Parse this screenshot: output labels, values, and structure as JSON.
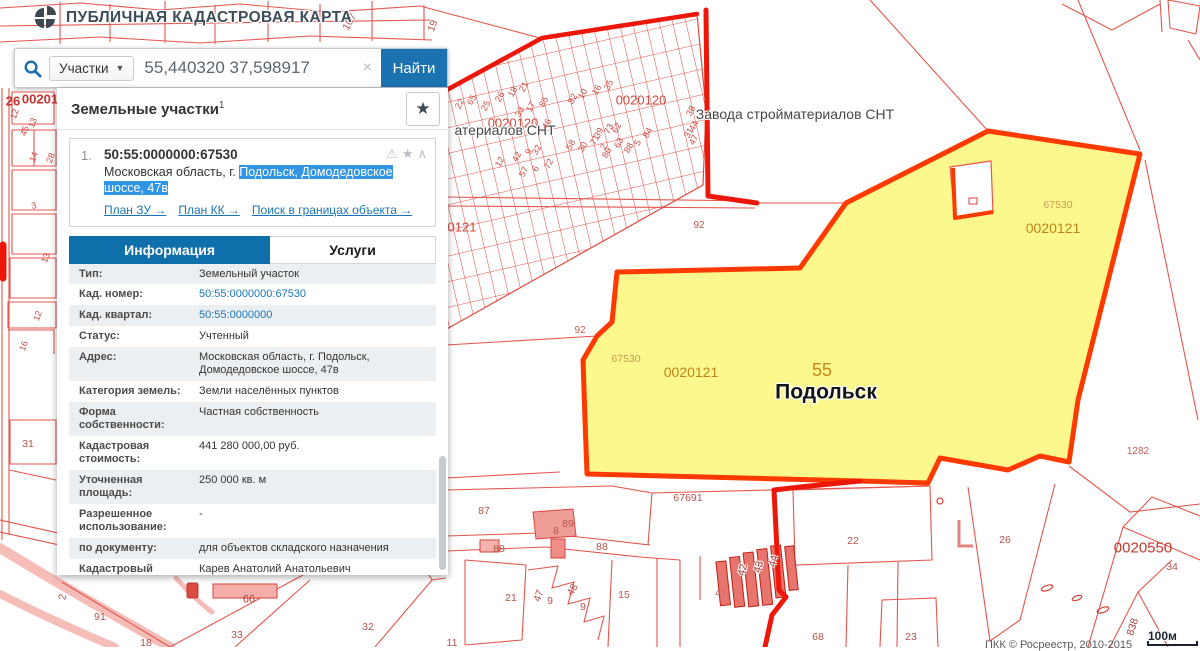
{
  "header": {
    "title": "ПУБЛИЧНАЯ КАДАСТРОВАЯ КАРТА"
  },
  "search": {
    "category": "Участки",
    "dropdown_arrow": "▼",
    "query": "55,440320 37,598917",
    "clear": "×",
    "submit": "Найти"
  },
  "panel": {
    "title": "Земельные участки",
    "count": "1",
    "fav_star": "★",
    "result": {
      "index": "1.",
      "cadastral_number": "50:55:0000000:67530",
      "address_prefix": "Московская область, г. ",
      "address_highlight": "Подольск, Домодедовское шоссе, 47в",
      "icon_glyphs": [
        "⚠",
        "★",
        "∧"
      ],
      "links": [
        {
          "label": "План ЗУ →"
        },
        {
          "label": "План КК →"
        },
        {
          "label": "Поиск в границах объекта →"
        }
      ]
    },
    "tabs": [
      {
        "label": "Информация",
        "active": true
      },
      {
        "label": "Услуги",
        "active": false
      }
    ],
    "info_rows": [
      {
        "label": "Тип:",
        "value": "Земельный участок"
      },
      {
        "label": "Кад. номер:",
        "value": "50:55:0000000:67530",
        "link": true
      },
      {
        "label": "Кад. квартал:",
        "value": "50:55:0000000",
        "link": true
      },
      {
        "label": "Статус:",
        "value": "Учтенный"
      },
      {
        "label": "Адрес:",
        "value": "Московская область, г. Подольск, Домодедовское шоссе, 47в"
      },
      {
        "label": "Категория земель:",
        "value": "Земли населённых пунктов"
      },
      {
        "label": "Форма собственности:",
        "value": "Частная собственность"
      },
      {
        "label": "Кадастровая стоимость:",
        "value": "441 280 000,00 руб."
      },
      {
        "label": "Уточненная площадь:",
        "value": "250 000 кв. м"
      },
      {
        "label": "Разрешенное использование:",
        "value": "-"
      },
      {
        "label": "по документу:",
        "value": "для объектов складского назначения"
      },
      {
        "label": "Кадастровый инженер:",
        "value": "Карев Анатолий Анатольевич"
      },
      {
        "label": "Дата постановки на учет:",
        "value": "06.08.2013"
      },
      {
        "label": "Дата изменения сведений в ГКН:",
        "value": "23.11.2016"
      }
    ]
  },
  "map": {
    "scale": "100м",
    "attribution": "ПКК © Росреестр, 2010-2015",
    "colors": {
      "accent_blue": "#1b72b1",
      "link_blue": "#1b76b8",
      "selection_blue": "#3194e4",
      "parcel_yellow": "#fcf88d",
      "parcel_border": "#ff3a00",
      "map_red": "#e4554c",
      "quarter_label_orange": "#c08416"
    },
    "labels": [
      {
        "t": "0020120",
        "x": 641,
        "y": 100,
        "cls": "q"
      },
      {
        "t": "0020120",
        "x": 513,
        "y": 123,
        "cls": "q"
      },
      {
        "t": "Завода стройматериалов СНТ",
        "x": 795,
        "y": 114,
        "cls": "name"
      },
      {
        "t": "атериалов СНТ",
        "x": 505,
        "y": 130,
        "cls": "name"
      },
      {
        "t": "0121",
        "x": 462,
        "y": 227,
        "cls": "q"
      },
      {
        "t": "92",
        "x": 699,
        "y": 226,
        "cls": "small"
      },
      {
        "t": "92",
        "x": 580,
        "y": 331,
        "cls": "small"
      },
      {
        "t": "67530",
        "x": 626,
        "y": 359,
        "cls": "parcel"
      },
      {
        "t": "0020121",
        "x": 691,
        "y": 372,
        "cls": "qo"
      },
      {
        "t": "55",
        "x": 822,
        "y": 370,
        "cls": "cityno"
      },
      {
        "t": "Подольск",
        "x": 826,
        "y": 392,
        "cls": "city"
      },
      {
        "t": "67530",
        "x": 1058,
        "y": 205,
        "cls": "parcel"
      },
      {
        "t": "0020121",
        "x": 1053,
        "y": 228,
        "cls": "qo"
      },
      {
        "t": "1282",
        "x": 1138,
        "y": 452,
        "cls": "small"
      },
      {
        "t": "67691",
        "x": 688,
        "y": 498,
        "cls": "small2"
      },
      {
        "t": "87",
        "x": 484,
        "y": 511,
        "cls": "small2"
      },
      {
        "t": "89",
        "x": 568,
        "y": 524,
        "cls": "small2"
      },
      {
        "t": "8",
        "x": 556,
        "y": 531,
        "cls": "small2"
      },
      {
        "t": "88",
        "x": 499,
        "y": 549,
        "cls": "small2"
      },
      {
        "t": "88",
        "x": 602,
        "y": 547,
        "cls": "small2"
      },
      {
        "t": "21",
        "x": 511,
        "y": 598,
        "cls": "small2"
      },
      {
        "t": "47",
        "x": 539,
        "y": 596,
        "cls": "small2",
        "rot": -70
      },
      {
        "t": "9",
        "x": 550,
        "y": 601,
        "cls": "small2"
      },
      {
        "t": "48",
        "x": 573,
        "y": 590,
        "cls": "small2",
        "rot": -60
      },
      {
        "t": "9",
        "x": 583,
        "y": 607,
        "cls": "small2"
      },
      {
        "t": "15",
        "x": 624,
        "y": 595,
        "cls": "small2"
      },
      {
        "t": "4",
        "x": 718,
        "y": 593,
        "cls": "small2"
      },
      {
        "t": "42",
        "x": 743,
        "y": 570,
        "cls": "small2h",
        "rot": -75
      },
      {
        "t": "43",
        "x": 759,
        "y": 567,
        "cls": "small2h",
        "rot": -75
      },
      {
        "t": "44",
        "x": 774,
        "y": 561,
        "cls": "small2h",
        "rot": -75
      },
      {
        "t": "22",
        "x": 853,
        "y": 541,
        "cls": "small2"
      },
      {
        "t": "26",
        "x": 1005,
        "y": 540,
        "cls": "small2"
      },
      {
        "t": "0020550",
        "x": 1143,
        "y": 548,
        "cls": "qd"
      },
      {
        "t": "34",
        "x": 1172,
        "y": 567,
        "cls": "small2"
      },
      {
        "t": "68",
        "x": 818,
        "y": 637,
        "cls": "small2"
      },
      {
        "t": "23",
        "x": 911,
        "y": 637,
        "cls": "small2"
      },
      {
        "t": "838",
        "x": 1133,
        "y": 627,
        "cls": "small2h",
        "rot": -72
      },
      {
        "t": "91",
        "x": 100,
        "y": 617,
        "cls": "small2"
      },
      {
        "t": "18",
        "x": 146,
        "y": 643,
        "cls": "small2"
      },
      {
        "t": "33",
        "x": 237,
        "y": 635,
        "cls": "small2"
      },
      {
        "t": "66",
        "x": 249,
        "y": 600,
        "cls": "qd2"
      },
      {
        "t": "32",
        "x": 368,
        "y": 627,
        "cls": "small2"
      },
      {
        "t": "11",
        "x": 452,
        "y": 643,
        "cls": "small2"
      },
      {
        "t": "2",
        "x": 63,
        "y": 597,
        "cls": "small2",
        "rot": -80
      },
      {
        "t": "26",
        "x": 13,
        "y": 101,
        "cls": "q2"
      },
      {
        "t": "00201",
        "x": 40,
        "y": 99,
        "cls": "q2"
      },
      {
        "t": "107",
        "x": 350,
        "y": 22,
        "cls": "small2",
        "rot": -60
      },
      {
        "t": "19",
        "x": 433,
        "y": 26,
        "cls": "small2",
        "rot": -70
      },
      {
        "t": "12",
        "x": 15,
        "y": 114,
        "cls": "snt",
        "rot": -70
      },
      {
        "t": "45",
        "x": 25,
        "y": 131,
        "cls": "snt",
        "rot": -70
      },
      {
        "t": "13",
        "x": 33,
        "y": 123,
        "cls": "snt",
        "rot": -70
      },
      {
        "t": "14",
        "x": 34,
        "y": 157,
        "cls": "snt",
        "rot": -70
      },
      {
        "t": "28",
        "x": 51,
        "y": 158,
        "cls": "snt",
        "rot": -70
      },
      {
        "t": "3",
        "x": 34,
        "y": 206,
        "cls": "snt",
        "rot": -15
      },
      {
        "t": "13",
        "x": 46,
        "y": 258,
        "cls": "snt",
        "rot": -70
      },
      {
        "t": "12",
        "x": 38,
        "y": 316,
        "cls": "snt",
        "rot": -70
      },
      {
        "t": "16",
        "x": 24,
        "y": 346,
        "cls": "snt",
        "rot": -70
      },
      {
        "t": "31",
        "x": 28,
        "y": 444,
        "cls": "small2"
      }
    ],
    "snt_numbers": [
      {
        "t": "22",
        "x": 460,
        "y": 104
      },
      {
        "t": "65",
        "x": 472,
        "y": 100
      },
      {
        "t": "25",
        "x": 486,
        "y": 106
      },
      {
        "t": "26",
        "x": 500,
        "y": 97
      },
      {
        "t": "18",
        "x": 513,
        "y": 92
      },
      {
        "t": "21",
        "x": 524,
        "y": 87
      },
      {
        "t": "33",
        "x": 520,
        "y": 112
      },
      {
        "t": "17",
        "x": 531,
        "y": 107
      },
      {
        "t": "85",
        "x": 544,
        "y": 102
      },
      {
        "t": "46",
        "x": 547,
        "y": 124
      },
      {
        "t": "82",
        "x": 573,
        "y": 99
      },
      {
        "t": "10",
        "x": 583,
        "y": 94
      },
      {
        "t": "16",
        "x": 597,
        "y": 90
      },
      {
        "t": "35",
        "x": 609,
        "y": 85
      },
      {
        "t": "58",
        "x": 571,
        "y": 145
      },
      {
        "t": "30",
        "x": 583,
        "y": 147
      },
      {
        "t": "71",
        "x": 595,
        "y": 140
      },
      {
        "t": "2",
        "x": 604,
        "y": 147
      },
      {
        "t": "39",
        "x": 599,
        "y": 133
      },
      {
        "t": "73",
        "x": 609,
        "y": 129
      },
      {
        "t": "86",
        "x": 607,
        "y": 153
      },
      {
        "t": "63",
        "x": 619,
        "y": 143
      },
      {
        "t": "62",
        "x": 617,
        "y": 128
      },
      {
        "t": "88",
        "x": 629,
        "y": 148
      },
      {
        "t": "5",
        "x": 638,
        "y": 143
      },
      {
        "t": "84",
        "x": 648,
        "y": 133
      },
      {
        "t": "12",
        "x": 500,
        "y": 162
      },
      {
        "t": "42",
        "x": 517,
        "y": 157
      },
      {
        "t": "9",
        "x": 529,
        "y": 152
      },
      {
        "t": "32",
        "x": 537,
        "y": 150
      },
      {
        "t": "57",
        "x": 524,
        "y": 172
      },
      {
        "t": "6",
        "x": 536,
        "y": 169
      },
      {
        "t": "72",
        "x": 549,
        "y": 164
      },
      {
        "t": "38",
        "x": 691,
        "y": 111
      },
      {
        "t": "44",
        "x": 694,
        "y": 126
      },
      {
        "t": "31",
        "x": 689,
        "y": 133
      },
      {
        "t": "47",
        "x": 694,
        "y": 140
      }
    ]
  }
}
